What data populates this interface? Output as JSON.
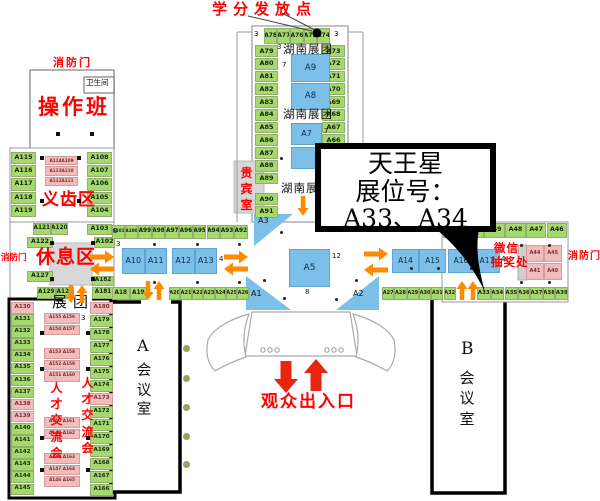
{
  "colors": {
    "green": "#a6d96d",
    "blue": "#7cc0ea",
    "pink": "#f3bcbc",
    "orange": "#ff8a00",
    "red_arrow": "#e8250f",
    "red_text": "#ff0000",
    "gray_area": "#d8d8d8"
  },
  "callout": {
    "line1": "天王星",
    "line2": "展位号：",
    "line3": "A33、A34"
  },
  "labels_list": [
    {
      "name": "credit-point-label",
      "text": "学分发放点",
      "x": 212,
      "y": 1,
      "fs": 15,
      "cls": "red",
      "ls": 6
    },
    {
      "name": "fire-door-top-label",
      "text": "消防门",
      "x": 53,
      "y": 57,
      "fs": 11,
      "cls": "red",
      "ls": 2
    },
    {
      "name": "fire-door-left-label",
      "text": "消防门",
      "x": 1,
      "y": 254,
      "fs": 8.5,
      "cls": "red"
    },
    {
      "name": "fire-door-right-label",
      "text": "消防门",
      "x": 568,
      "y": 251,
      "fs": 10,
      "cls": "red",
      "ls": 1
    },
    {
      "name": "restroom-label",
      "text": "卫生间",
      "x": 86,
      "y": 79,
      "fs": 7.5,
      "cls": "blk serif"
    },
    {
      "name": "operation-class-label",
      "text": "操作班",
      "x": 38,
      "y": 95,
      "fs": 21,
      "cls": "red",
      "ls": 3
    },
    {
      "name": "dental-zone-label",
      "text": "义齿区",
      "x": 42,
      "y": 191,
      "fs": 17,
      "cls": "red",
      "ls": 1
    },
    {
      "name": "vip-room-label",
      "text": "贵宾室",
      "x": 240,
      "y": 165,
      "fs": 12,
      "cls": "red vert",
      "w": 13
    },
    {
      "name": "hunan-group-label-1",
      "text": "湖南展团",
      "x": 283,
      "y": 43,
      "fs": 11.5,
      "cls": "blk serif",
      "ls": 1
    },
    {
      "name": "hunan-group-label-2",
      "text": "湖南展团",
      "x": 283,
      "y": 108,
      "fs": 11.5,
      "cls": "blk serif",
      "ls": 1
    },
    {
      "name": "hunan-group-label-3",
      "text": "湖南展团",
      "x": 281,
      "y": 182,
      "fs": 11.5,
      "cls": "blk serif",
      "ls": 1
    },
    {
      "name": "rest-area-label",
      "text": "休息区",
      "x": 36,
      "y": 247,
      "fs": 19,
      "cls": "red",
      "ls": 1
    },
    {
      "name": "exhibition-group-label",
      "text": "展团",
      "x": 52,
      "y": 294,
      "fs": 15,
      "cls": "blk serif",
      "ls": 6
    },
    {
      "name": "talent-fair-label-left",
      "text": "人才交流会",
      "x": 50,
      "y": 380,
      "fs": 12,
      "cls": "red vert",
      "w": 13
    },
    {
      "name": "talent-fair-label-right",
      "text": "人才交流会",
      "x": 81,
      "y": 375,
      "fs": 12,
      "cls": "red vert",
      "w": 13
    },
    {
      "name": "wechat-lottery-label-1",
      "text": "微信",
      "x": 494,
      "y": 242,
      "fs": 11.5,
      "cls": "red",
      "ls": 1
    },
    {
      "name": "wechat-lottery-label-2",
      "text": "抽奖处",
      "x": 491,
      "y": 256,
      "fs": 11.5,
      "cls": "red",
      "ls": 1
    },
    {
      "name": "audience-entrance-label",
      "text": "观众出入口",
      "x": 261,
      "y": 393,
      "fs": 17,
      "cls": "red",
      "ls": 2
    },
    {
      "name": "room-a-letter",
      "text": "A",
      "x": 137,
      "y": 337,
      "fs": 16,
      "cls": "blk serif"
    },
    {
      "name": "room-a-name",
      "text": "会议室",
      "x": 136,
      "y": 362,
      "fs": 14.5,
      "cls": "blk serif vert",
      "w": 16
    },
    {
      "name": "room-b-letter",
      "text": "B",
      "x": 461,
      "y": 340,
      "fs": 17,
      "cls": "blk serif"
    },
    {
      "name": "room-b-name",
      "text": "会议室",
      "x": 459,
      "y": 368,
      "fs": 15,
      "cls": "blk serif vert",
      "w": 16
    },
    {
      "name": "booth-a3-label",
      "text": "A3",
      "x": 258,
      "y": 216,
      "fs": 8,
      "cls": "blk"
    },
    {
      "name": "booth-a1-label",
      "text": "A1",
      "x": 251,
      "y": 289,
      "fs": 8,
      "cls": "blk"
    },
    {
      "name": "booth-a2-label",
      "text": "A2",
      "x": 353,
      "y": 289,
      "fs": 8,
      "cls": "blk"
    },
    {
      "name": "aisle-num",
      "text": "3",
      "x": 254,
      "y": 30,
      "fs": 7,
      "cls": "blk"
    },
    {
      "name": "aisle-num",
      "text": "3",
      "x": 334,
      "y": 30,
      "fs": 7,
      "cls": "blk"
    },
    {
      "name": "aisle-num",
      "text": "3",
      "x": 277,
      "y": 43,
      "fs": 7,
      "cls": "blk"
    },
    {
      "name": "aisle-num",
      "text": "7",
      "x": 282,
      "y": 61,
      "fs": 7,
      "cls": "blk"
    },
    {
      "name": "aisle-num",
      "text": "7",
      "x": 324,
      "y": 127,
      "fs": 7,
      "cls": "blk"
    },
    {
      "name": "aisle-num",
      "text": "3",
      "x": 113,
      "y": 227,
      "fs": 7,
      "cls": "blk"
    },
    {
      "name": "aisle-num",
      "text": "3",
      "x": 116,
      "y": 240,
      "fs": 7,
      "cls": "blk"
    },
    {
      "name": "aisle-num",
      "text": "4",
      "x": 219,
      "y": 255,
      "fs": 7,
      "cls": "blk"
    },
    {
      "name": "aisle-num",
      "text": "12",
      "x": 332,
      "y": 252,
      "fs": 7,
      "cls": "blk"
    },
    {
      "name": "aisle-num",
      "text": "8",
      "x": 305,
      "y": 288,
      "fs": 7,
      "cls": "blk"
    },
    {
      "name": "aisle-num",
      "text": "4",
      "x": 501,
      "y": 255,
      "fs": 7,
      "cls": "blk"
    },
    {
      "name": "aisle-num",
      "text": "3",
      "x": 81,
      "y": 314,
      "fs": 7,
      "cls": "blk"
    }
  ],
  "booth_groups": [
    {
      "ids": [
        "A78",
        "A77",
        "A76",
        "A75",
        "A74"
      ],
      "x": 264,
      "y": 28,
      "dx": 13.2,
      "w": 13.2,
      "h": 16,
      "fs": 6
    },
    {
      "ids": [
        "A79",
        "A80",
        "A81",
        "A82",
        "A83",
        "A84",
        "A85",
        "A86",
        "A87",
        "A88",
        "A89"
      ],
      "x": 255,
      "y": 45,
      "dy": 12.75,
      "w": 23,
      "h": 11.8,
      "fs": 6.5
    },
    {
      "ids": [
        "A90",
        "A91"
      ],
      "x": 255,
      "y": 193,
      "dy": 12.75,
      "w": 23,
      "h": 11.8,
      "fs": 6.5
    },
    {
      "ids": [
        "A73",
        "A72",
        "A71",
        "A70",
        "A69",
        "A68",
        "A67",
        "A66"
      ],
      "x": 322,
      "y": 45,
      "dy": 12.75,
      "w": 23,
      "h": 11.8,
      "fs": 6.5
    },
    {
      "ids": [
        "A9"
      ],
      "x": 291,
      "y": 54,
      "w": 39,
      "h": 28,
      "fs": 8.5,
      "color": "blue"
    },
    {
      "ids": [
        "A8"
      ],
      "x": 291,
      "y": 83,
      "w": 39,
      "h": 27,
      "fs": 8.5,
      "color": "blue"
    },
    {
      "ids": [
        "A7"
      ],
      "x": 291,
      "y": 123,
      "w": 31,
      "h": 22,
      "fs": 8,
      "color": "blue"
    },
    {
      "ids": [
        " "
      ],
      "x": 291,
      "y": 147,
      "w": 31,
      "h": 22,
      "fs": 8,
      "color": "blue"
    },
    {
      "ids": [
        "A5"
      ],
      "x": 289,
      "y": 249,
      "w": 41,
      "h": 38,
      "fs": 9,
      "color": "blue"
    },
    {
      "ids": [
        "A115",
        "A116",
        "A117",
        "A118",
        "A119"
      ],
      "x": 11,
      "y": 152,
      "dy": 13.2,
      "w": 25,
      "h": 12.2,
      "fs": 6.3
    },
    {
      "ids": [
        "A108",
        "A107",
        "A106",
        "A105",
        "A104"
      ],
      "x": 87,
      "y": 152,
      "dy": 13.2,
      "w": 25,
      "h": 12.2,
      "fs": 6.3
    },
    {
      "ids": [
        "A114A109",
        "A113A110",
        "A112A111"
      ],
      "x": 45,
      "y": 156,
      "dy": 10.4,
      "w": 33,
      "h": 9.4,
      "fs": 4.2,
      "color": "pink"
    },
    {
      "ids": [
        "A121",
        "A120"
      ],
      "x": 33,
      "y": 223,
      "dx": 17.5,
      "w": 17.5,
      "h": 12,
      "fs": 5.8
    },
    {
      "ids": [
        "A122"
      ],
      "x": 27,
      "y": 237,
      "w": 26,
      "h": 11,
      "fs": 6.3
    },
    {
      "ids": [
        "A103"
      ],
      "x": 87,
      "y": 224,
      "w": 25,
      "h": 11,
      "fs": 6.3
    },
    {
      "ids": [
        "A102"
      ],
      "x": 94,
      "y": 237,
      "w": 21,
      "h": 11,
      "fs": 6.3
    },
    {
      "ids": [
        "A127"
      ],
      "x": 27,
      "y": 271,
      "w": 26,
      "h": 11,
      "fs": 6.3
    },
    {
      "ids": [
        "A129",
        "A128"
      ],
      "x": 37,
      "y": 287,
      "dx": 18.5,
      "w": 18.5,
      "h": 12,
      "fs": 5.8
    },
    {
      "ids": [
        "A182"
      ],
      "x": 92,
      "y": 276,
      "w": 22,
      "h": 10,
      "fs": 5.8
    },
    {
      "ids": [
        "A181"
      ],
      "x": 92,
      "y": 287,
      "w": 22,
      "h": 12,
      "fs": 5.8
    },
    {
      "ids": [
        "A101",
        "A100"
      ],
      "x": 112,
      "y": 225,
      "dx": 13,
      "w": 13,
      "h": 13.5,
      "fs": 4.3
    },
    {
      "ids": [
        "A99",
        "A98",
        "A97",
        "A96",
        "A95",
        "A94",
        "A93",
        "A92"
      ],
      "x": 138,
      "y": 225,
      "dx": 13.7,
      "w": 13.7,
      "h": 13.5,
      "fs": 5.8
    },
    {
      "ids": [
        "A10",
        "A11"
      ],
      "x": 122,
      "y": 248,
      "dx": 22.5,
      "w": 22.5,
      "h": 26,
      "fs": 8,
      "color": "blue"
    },
    {
      "ids": [
        "A12",
        "A13"
      ],
      "x": 172,
      "y": 248,
      "dx": 22.5,
      "w": 22.5,
      "h": 26,
      "fs": 8,
      "color": "blue"
    },
    {
      "ids": [
        "A14",
        "A15"
      ],
      "x": 392,
      "y": 249,
      "dx": 27,
      "w": 27,
      "h": 24,
      "fs": 7.5,
      "color": "blue"
    },
    {
      "ids": [
        "A16",
        "A17"
      ],
      "x": 448,
      "y": 249,
      "dx": 26,
      "w": 26,
      "h": 24,
      "fs": 7.5,
      "color": "blue"
    },
    {
      "ids": [
        "A18",
        "A19"
      ],
      "x": 112,
      "y": 287,
      "dx": 17.5,
      "w": 17.5,
      "h": 13,
      "fs": 5.8
    },
    {
      "ids": [
        "A20",
        "A21",
        "A22",
        "A23",
        "A24",
        "A25",
        "A26"
      ],
      "x": 169,
      "y": 287,
      "dx": 11.4,
      "w": 11.4,
      "h": 13,
      "fs": 5
    },
    {
      "ids": [
        "A27",
        "A28",
        "A29",
        "A30",
        "A31",
        "A32"
      ],
      "x": 382,
      "y": 287,
      "dx": 12.3,
      "w": 12.3,
      "h": 13,
      "fs": 5
    },
    {
      "ids": [
        "A33",
        "A34"
      ],
      "x": 477,
      "y": 287,
      "dx": 13.5,
      "w": 13.5,
      "h": 13,
      "fs": 5.5
    },
    {
      "ids": [
        "A35",
        "A36",
        "A37",
        "A38",
        "A39"
      ],
      "x": 505,
      "y": 287,
      "dx": 12.6,
      "w": 12.6,
      "h": 13,
      "fs": 5.5
    },
    {
      "ids": [
        "A51",
        "A50",
        "A49",
        "A48",
        "A47",
        "A46"
      ],
      "x": 443,
      "y": 223,
      "dx": 20.7,
      "w": 20.7,
      "h": 14.5,
      "fs": 6.3
    },
    {
      "ids": [
        "A44",
        "A45"
      ],
      "x": 526,
      "y": 245,
      "dx": 17.8,
      "w": 17.8,
      "h": 17,
      "fs": 5,
      "color": "pink"
    },
    {
      "ids": [
        "A41",
        "A40"
      ],
      "x": 526,
      "y": 263,
      "dx": 17.8,
      "w": 17.8,
      "h": 17,
      "fs": 5,
      "color": "pink"
    },
    {
      "ids": [
        "A130",
        "A131",
        "A132",
        "A133",
        "A134",
        "A135",
        "A136",
        "A137",
        "A138",
        "A139",
        "A140",
        "A141",
        "A142",
        "A143",
        "A144",
        "A145"
      ],
      "x": 11,
      "y": 302,
      "dy": 12.1,
      "w": 23,
      "h": 11.5,
      "fs": 5.6,
      "pinkIds": [
        "A130",
        "A138",
        "A139"
      ]
    },
    {
      "ids": [
        "A180",
        "A179",
        "A178",
        "A177",
        "A176",
        "A175",
        "A174",
        "A173",
        "A172",
        "A171",
        "A170",
        "A169",
        "A168",
        "A167",
        "A166"
      ],
      "x": 90,
      "y": 302,
      "dy": 13,
      "w": 23,
      "h": 11.5,
      "fs": 5.6,
      "pinkIds": [
        "A180",
        "A173"
      ]
    },
    {
      "ids": [
        "A155 A156",
        "A154 A157"
      ],
      "x": 44,
      "y": 313,
      "dy": 11.5,
      "w": 36,
      "h": 10.5,
      "fs": 4.3,
      "color": "pink"
    },
    {
      "ids": [
        "A153 A158",
        "A152 A159",
        "A151 A160"
      ],
      "x": 44,
      "y": 348,
      "dy": 11.5,
      "w": 36,
      "h": 10.5,
      "fs": 4.3,
      "color": "pink"
    },
    {
      "ids": [
        "A150 A161",
        "A149 A162"
      ],
      "x": 44,
      "y": 417,
      "dy": 11.5,
      "w": 36,
      "h": 10.5,
      "fs": 4.3,
      "color": "pink"
    },
    {
      "ids": [
        "A148 A163",
        "A147 A164",
        "A146 A165"
      ],
      "x": 44,
      "y": 453,
      "dy": 11.5,
      "w": 36,
      "h": 10.5,
      "fs": 4.3,
      "color": "pink"
    }
  ],
  "arrows": [
    {
      "name": "arrow-right-rest",
      "dir": "right",
      "x": 90,
      "y": 257,
      "len": 24,
      "c": "o"
    },
    {
      "name": "arrow-left-rest",
      "dir": "left",
      "x": 90,
      "y": 269,
      "len": 24,
      "c": "o"
    },
    {
      "name": "arrow-right-tower-left",
      "dir": "right",
      "x": 224,
      "y": 257,
      "len": 24,
      "c": "o"
    },
    {
      "name": "arrow-left-tower-left",
      "dir": "left",
      "x": 224,
      "y": 269,
      "len": 24,
      "c": "o"
    },
    {
      "name": "arrow-right-tower-right",
      "dir": "right",
      "x": 364,
      "y": 254,
      "len": 24,
      "c": "o"
    },
    {
      "name": "arrow-left-tower-right",
      "dir": "left",
      "x": 364,
      "y": 270,
      "len": 24,
      "c": "o"
    },
    {
      "name": "arrow-down-hunan",
      "dir": "down",
      "x": 303,
      "y": 196,
      "len": 20,
      "c": "o"
    },
    {
      "name": "arrow-down-room-a",
      "dir": "down",
      "x": 148,
      "y": 281,
      "len": 19,
      "c": "o"
    },
    {
      "name": "arrow-up-room-a",
      "dir": "up",
      "x": 159,
      "y": 281,
      "len": 19,
      "c": "o"
    },
    {
      "name": "arrow-down-group",
      "dir": "down",
      "x": 71,
      "y": 285,
      "len": 18,
      "c": "o"
    },
    {
      "name": "arrow-up-group",
      "dir": "up",
      "x": 82,
      "y": 285,
      "len": 18,
      "c": "o"
    },
    {
      "name": "arrow-up-room-b-1",
      "dir": "up",
      "x": 462,
      "y": 281,
      "len": 19,
      "c": "o"
    },
    {
      "name": "arrow-up-room-b-2",
      "dir": "up",
      "x": 473,
      "y": 281,
      "len": 19,
      "c": "o"
    },
    {
      "name": "arrow-down-entrance",
      "dir": "down",
      "x": 286,
      "y": 361,
      "len": 32,
      "c": "r",
      "big": true
    },
    {
      "name": "arrow-up-entrance",
      "dir": "up",
      "x": 316,
      "y": 359,
      "len": 32,
      "c": "r",
      "big": true
    }
  ],
  "dots": [
    [
      153,
      243
    ],
    [
      196,
      243
    ],
    [
      238,
      243
    ],
    [
      280,
      231
    ],
    [
      153,
      281
    ],
    [
      196,
      281
    ],
    [
      238,
      281
    ],
    [
      263,
      279
    ],
    [
      283,
      297
    ],
    [
      335,
      298
    ],
    [
      355,
      279
    ],
    [
      410,
      267
    ],
    [
      437,
      267
    ],
    [
      520,
      244
    ],
    [
      548,
      244
    ],
    [
      520,
      281
    ],
    [
      548,
      281
    ],
    [
      470,
      267
    ],
    [
      280,
      157
    ]
  ],
  "squares": [
    [
      50,
      241
    ],
    [
      91,
      241
    ],
    [
      50,
      277
    ],
    [
      91,
      277
    ],
    [
      40,
      156
    ],
    [
      77,
      156
    ],
    [
      40,
      199
    ],
    [
      77,
      199
    ],
    [
      56,
      132
    ],
    [
      90,
      132
    ],
    [
      40,
      331
    ],
    [
      86,
      331
    ],
    [
      40,
      367
    ],
    [
      86,
      367
    ],
    [
      40,
      436
    ],
    [
      86,
      436
    ],
    [
      40,
      468
    ],
    [
      86,
      468
    ]
  ],
  "green_dots": [
    [
      183,
      345
    ],
    [
      183,
      375
    ],
    [
      183,
      404
    ],
    [
      183,
      433
    ],
    [
      183,
      461
    ]
  ]
}
